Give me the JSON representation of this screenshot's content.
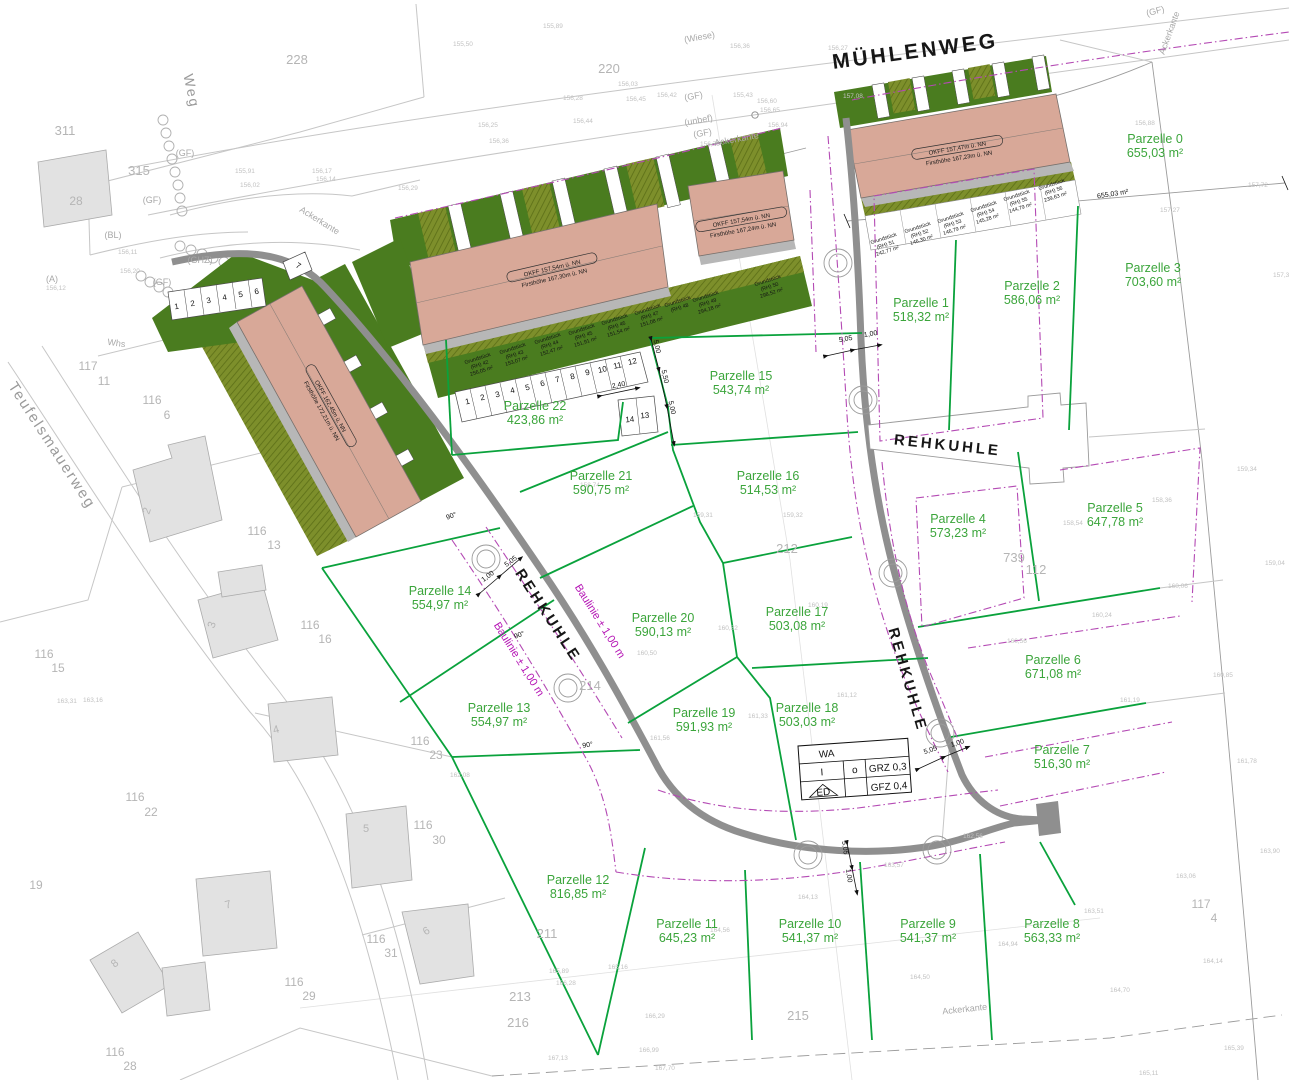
{
  "colors": {
    "parcel_green": "#3ba53b",
    "line_green": "#0aa23c",
    "building_fill": "#d8a898",
    "dark_green": "#4a7c1f",
    "olive": "#7d8f2b",
    "magenta": "#b44ab4",
    "road_gray": "#8f8f8f"
  },
  "legend": {
    "wa": "WA",
    "i": "I",
    "o": "o",
    "grz": "GRZ 0,3",
    "ed": "ED",
    "gfz": "GFZ 0,4"
  },
  "streets": [
    {
      "t": "MÜHLENWEG",
      "x": 916,
      "y": 58,
      "r": -7.5,
      "s": 21
    },
    {
      "t": "REHKUHLE",
      "x": 947,
      "y": 450,
      "r": 6,
      "s": 15
    },
    {
      "t": "REHKUHLE",
      "x": 544,
      "y": 618,
      "r": 57,
      "s": 15
    },
    {
      "t": "REHKUHLE",
      "x": 903,
      "y": 681,
      "r": 74,
      "s": 15
    }
  ],
  "gray_streets": [
    {
      "t": "Teufelsmauerweg",
      "x": 48,
      "y": 448,
      "r": 57,
      "s": 15
    },
    {
      "t": "Weg",
      "x": 187,
      "y": 92,
      "r": 78,
      "s": 14
    }
  ],
  "parcels": [
    {
      "label": "Parzelle 0",
      "area": "655,03 m²",
      "x": 1155,
      "y": 143
    },
    {
      "label": "Parzelle 1",
      "area": "518,32 m²",
      "x": 921,
      "y": 307
    },
    {
      "label": "Parzelle 2",
      "area": "586,06 m²",
      "x": 1032,
      "y": 290
    },
    {
      "label": "Parzelle 3",
      "area": "703,60 m²",
      "x": 1153,
      "y": 272
    },
    {
      "label": "Parzelle 4",
      "area": "573,23 m²",
      "x": 958,
      "y": 523
    },
    {
      "label": "Parzelle 5",
      "area": "647,78 m²",
      "x": 1115,
      "y": 512
    },
    {
      "label": "Parzelle 6",
      "area": "671,08 m²",
      "x": 1053,
      "y": 664
    },
    {
      "label": "Parzelle 7",
      "area": "516,30 m²",
      "x": 1062,
      "y": 754
    },
    {
      "label": "Parzelle 8",
      "area": "563,33 m²",
      "x": 1052,
      "y": 928
    },
    {
      "label": "Parzelle 9",
      "area": "541,37 m²",
      "x": 928,
      "y": 928
    },
    {
      "label": "Parzelle 10",
      "area": "541,37 m²",
      "x": 810,
      "y": 928
    },
    {
      "label": "Parzelle 11",
      "area": "645,23 m²",
      "x": 687,
      "y": 928
    },
    {
      "label": "Parzelle 12",
      "area": "816,85 m²",
      "x": 578,
      "y": 884
    },
    {
      "label": "Parzelle 13",
      "area": "554,97 m²",
      "x": 499,
      "y": 712
    },
    {
      "label": "Parzelle 14",
      "area": "554,97 m²",
      "x": 440,
      "y": 595
    },
    {
      "label": "Parzelle 15",
      "area": "543,74 m²",
      "x": 741,
      "y": 380
    },
    {
      "label": "Parzelle 16",
      "area": "514,53 m²",
      "x": 768,
      "y": 480
    },
    {
      "label": "Parzelle 17",
      "area": "503,08 m²",
      "x": 797,
      "y": 616
    },
    {
      "label": "Parzelle 18",
      "area": "503,03 m²",
      "x": 807,
      "y": 712
    },
    {
      "label": "Parzelle 19",
      "area": "591,93 m²",
      "x": 704,
      "y": 717
    },
    {
      "label": "Parzelle 20",
      "area": "590,13 m²",
      "x": 663,
      "y": 622
    },
    {
      "label": "Parzelle 21",
      "area": "590,75 m²",
      "x": 601,
      "y": 480
    },
    {
      "label": "Parzelle 22",
      "area": "423,86 m²",
      "x": 535,
      "y": 410
    }
  ],
  "buildings": [
    {
      "l1": "OKFF 157,47m ü. NN",
      "l2": "Firsthöhe 167,23m ü. NN",
      "x": 958,
      "y": 152,
      "r": -9.5
    },
    {
      "l1": "OKFF 157,54m ü. NN",
      "l2": "Firsthöhe 167,30m ü. NN",
      "x": 553,
      "y": 272,
      "r": -13
    },
    {
      "l1": "OKFF 157,54m ü. NN",
      "l2": "Firsthöhe 167,24m ü. NN",
      "x": 742,
      "y": 224,
      "r": -10
    },
    {
      "l1": "OKFF 162,45m ü. NN",
      "l2": "Firsthöhe 172,21m ü. NN",
      "x": 327,
      "y": 408,
      "r": 61
    }
  ],
  "grundstuecke": [
    {
      "a": "Grundstück",
      "b": "(RH) 51",
      "c": "242,77 m²",
      "x": 884,
      "y": 240,
      "r": -18
    },
    {
      "a": "Grundstück",
      "b": "(RH) 52",
      "c": "146,30 m²",
      "x": 918,
      "y": 229,
      "r": -18
    },
    {
      "a": "Grundstück",
      "b": "(RH) 53",
      "c": "146,79 m²",
      "x": 951,
      "y": 219,
      "r": -18
    },
    {
      "a": "Grundstück",
      "b": "(RH) 54",
      "c": "145,28 m²",
      "x": 984,
      "y": 208,
      "r": -18
    },
    {
      "a": "Grundstück",
      "b": "(RH) 55",
      "c": "144,79 m²",
      "x": 1017,
      "y": 197,
      "r": -18
    },
    {
      "a": "Grundstück",
      "b": "(RH) 56",
      "c": "239,63 m²",
      "x": 1052,
      "y": 186,
      "r": -18
    },
    {
      "a": "Grundstück",
      "b": "(RH) 42",
      "c": "256,05 m²",
      "x": 478,
      "y": 360,
      "r": -18
    },
    {
      "a": "Grundstück",
      "b": "(RH) 43",
      "c": "153,07 m²",
      "x": 513,
      "y": 350,
      "r": -18
    },
    {
      "a": "Grundstück",
      "b": "(RH) 44",
      "c": "152,47 m²",
      "x": 548,
      "y": 340,
      "r": -18
    },
    {
      "a": "Grundstück",
      "b": "(RH) 45",
      "c": "151,91 m²",
      "x": 582,
      "y": 331,
      "r": -18
    },
    {
      "a": "Grundstück",
      "b": "(RH) 46",
      "c": "151,54 m²",
      "x": 615,
      "y": 321,
      "r": -18
    },
    {
      "a": "Grundstück",
      "b": "(RH) 47",
      "c": "151,08 m²",
      "x": 648,
      "y": 311,
      "r": -18
    },
    {
      "a": "Grundstück",
      "b": "(RH) 48",
      "c": "",
      "x": 678,
      "y": 303,
      "r": -18
    },
    {
      "a": "Grundstück",
      "b": "(RH) 49",
      "c": "294,18 m²",
      "x": 706,
      "y": 298,
      "r": -18
    },
    {
      "a": "Grundstück",
      "b": "(RH) 50",
      "c": "298,52 m²",
      "x": 768,
      "y": 282,
      "r": -18
    }
  ],
  "baulinie": [
    {
      "t": "Baulinie ± 1,00 m",
      "x": 597,
      "y": 623,
      "r": 58
    },
    {
      "t": "Baulinie ± 1,00 m",
      "x": 516,
      "y": 661,
      "r": 58
    }
  ],
  "dims": [
    {
      "t": "5,05",
      "x": 846,
      "y": 341,
      "r": -10
    },
    {
      "t": "1,00",
      "x": 871,
      "y": 336,
      "r": -10
    },
    {
      "t": "5,05",
      "x": 931,
      "y": 752,
      "r": -18
    },
    {
      "t": "1,00",
      "x": 958,
      "y": 745,
      "r": -18
    },
    {
      "t": "5,05",
      "x": 843,
      "y": 848,
      "r": 82
    },
    {
      "t": "1,00",
      "x": 847,
      "y": 876,
      "r": 82
    },
    {
      "t": "5,05",
      "x": 512,
      "y": 563,
      "r": -37
    },
    {
      "t": "1,00",
      "x": 489,
      "y": 578,
      "r": -37
    },
    {
      "t": "5,00",
      "x": 655,
      "y": 347,
      "r": 77
    },
    {
      "t": "5,50",
      "x": 663,
      "y": 377,
      "r": 77
    },
    {
      "t": "5,00",
      "x": 670,
      "y": 408,
      "r": 77
    },
    {
      "t": "2,40",
      "x": 619,
      "y": 387,
      "r": -12
    },
    {
      "t": "655,03 m²",
      "x": 1113,
      "y": 196,
      "r": -9,
      "s": 8
    }
  ],
  "angles": [
    {
      "t": "90°",
      "x": 520,
      "y": 637,
      "r": -20
    },
    {
      "t": "90°",
      "x": 588,
      "y": 747,
      "r": -10
    },
    {
      "t": "90°",
      "x": 452,
      "y": 518,
      "r": -20
    }
  ],
  "gray_numbers": [
    {
      "t": "228",
      "x": 297,
      "y": 64
    },
    {
      "t": "220",
      "x": 609,
      "y": 73
    },
    {
      "t": "311",
      "x": 65,
      "y": 135
    },
    {
      "t": "315",
      "x": 139,
      "y": 175
    },
    {
      "t": "28",
      "x": 76,
      "y": 205,
      "s": 12
    },
    {
      "t": "212",
      "x": 787,
      "y": 553
    },
    {
      "t": "214",
      "x": 590,
      "y": 690
    },
    {
      "t": "739",
      "x": 1014,
      "y": 562
    },
    {
      "t": "112",
      "x": 1036,
      "y": 574
    },
    {
      "t": "215",
      "x": 798,
      "y": 1020
    },
    {
      "t": "211",
      "x": 547,
      "y": 938
    },
    {
      "t": "213",
      "x": 520,
      "y": 1001
    },
    {
      "t": "216",
      "x": 518,
      "y": 1027
    },
    {
      "t": "19",
      "x": 36,
      "y": 889,
      "s": 12
    },
    {
      "t": "117",
      "x": 88,
      "y": 370,
      "s": 12
    },
    {
      "t": "11",
      "x": 104,
      "y": 385,
      "s": 12
    },
    {
      "t": "116",
      "x": 152,
      "y": 404,
      "s": 12
    },
    {
      "t": "6",
      "x": 167,
      "y": 419,
      "s": 12
    },
    {
      "t": "116",
      "x": 257,
      "y": 535,
      "s": 12
    },
    {
      "t": "13",
      "x": 274,
      "y": 549,
      "s": 12
    },
    {
      "t": "116",
      "x": 310,
      "y": 629,
      "s": 12
    },
    {
      "t": "16",
      "x": 325,
      "y": 643,
      "s": 12
    },
    {
      "t": "116",
      "x": 44,
      "y": 658,
      "s": 12
    },
    {
      "t": "15",
      "x": 58,
      "y": 672,
      "s": 12
    },
    {
      "t": "116",
      "x": 420,
      "y": 745,
      "s": 12
    },
    {
      "t": "23",
      "x": 436,
      "y": 759,
      "s": 12
    },
    {
      "t": "116",
      "x": 135,
      "y": 801,
      "s": 12
    },
    {
      "t": "22",
      "x": 151,
      "y": 816,
      "s": 12
    },
    {
      "t": "116",
      "x": 423,
      "y": 829,
      "s": 12
    },
    {
      "t": "30",
      "x": 439,
      "y": 844,
      "s": 12
    },
    {
      "t": "116",
      "x": 376,
      "y": 943,
      "s": 12
    },
    {
      "t": "31",
      "x": 391,
      "y": 957,
      "s": 12
    },
    {
      "t": "116",
      "x": 294,
      "y": 986,
      "s": 12
    },
    {
      "t": "29",
      "x": 309,
      "y": 1000,
      "s": 12
    },
    {
      "t": "116",
      "x": 115,
      "y": 1056,
      "s": 12
    },
    {
      "t": "28",
      "x": 130,
      "y": 1070,
      "s": 12
    },
    {
      "t": "117",
      "x": 1201,
      "y": 908,
      "s": 12
    },
    {
      "t": "4",
      "x": 1214,
      "y": 922,
      "s": 12
    },
    {
      "t": "2",
      "x": 150,
      "y": 512,
      "s": 11,
      "r": -70
    },
    {
      "t": "3",
      "x": 215,
      "y": 626,
      "s": 11,
      "r": -70
    },
    {
      "t": "4",
      "x": 277,
      "y": 733,
      "s": 11,
      "r": -15
    },
    {
      "t": "5",
      "x": 366,
      "y": 832,
      "s": 11
    },
    {
      "t": "6",
      "x": 428,
      "y": 934,
      "s": 11,
      "r": -30
    },
    {
      "t": "7",
      "x": 229,
      "y": 908,
      "s": 11,
      "r": -15
    },
    {
      "t": "8",
      "x": 117,
      "y": 966,
      "s": 11,
      "r": -40
    }
  ],
  "misc": [
    {
      "t": "(Wiese)",
      "x": 700,
      "y": 40,
      "r": -10
    },
    {
      "t": "(GF)",
      "x": 694,
      "y": 99,
      "r": -10
    },
    {
      "t": "(unbef)",
      "x": 699,
      "y": 123,
      "r": -10
    },
    {
      "t": "(GF)",
      "x": 703,
      "y": 136,
      "r": -10
    },
    {
      "t": "(GF)",
      "x": 185,
      "y": 156,
      "r": 0
    },
    {
      "t": "(GF)",
      "x": 152,
      "y": 203,
      "r": 0
    },
    {
      "t": "(GHZ)",
      "x": 200,
      "y": 263,
      "r": 0
    },
    {
      "t": "(BL)",
      "x": 113,
      "y": 238,
      "r": 0
    },
    {
      "t": "(A)",
      "x": 52,
      "y": 282,
      "r": 0
    },
    {
      "t": "(GF)",
      "x": 162,
      "y": 285,
      "r": 0
    },
    {
      "t": "Whs",
      "x": 116,
      "y": 346,
      "r": 8
    },
    {
      "t": "Ackerkante",
      "x": 318,
      "y": 223,
      "r": 32
    },
    {
      "t": "Ackerkante",
      "x": 737,
      "y": 142,
      "r": -10
    },
    {
      "t": "Ackerkante",
      "x": 965,
      "y": 1012,
      "r": -6
    },
    {
      "t": "Ackerkante",
      "x": 1172,
      "y": 34,
      "r": -70
    },
    {
      "t": "(GF)",
      "x": 1156,
      "y": 14,
      "r": -15
    }
  ],
  "parking": [
    {
      "t": "1",
      "x": 468,
      "y": 404,
      "r": -13
    },
    {
      "t": "2",
      "x": 483,
      "y": 400,
      "r": -13
    },
    {
      "t": "3",
      "x": 498,
      "y": 397,
      "r": -13
    },
    {
      "t": "4",
      "x": 513,
      "y": 393,
      "r": -13
    },
    {
      "t": "5",
      "x": 528,
      "y": 390,
      "r": -13
    },
    {
      "t": "6",
      "x": 543,
      "y": 386,
      "r": -13
    },
    {
      "t": "7",
      "x": 558,
      "y": 382,
      "r": -13
    },
    {
      "t": "8",
      "x": 573,
      "y": 379,
      "r": -13
    },
    {
      "t": "9",
      "x": 588,
      "y": 375,
      "r": -13
    },
    {
      "t": "10",
      "x": 603,
      "y": 372,
      "r": -13
    },
    {
      "t": "11",
      "x": 618,
      "y": 368,
      "r": -13
    },
    {
      "t": "12",
      "x": 633,
      "y": 364,
      "r": -13
    },
    {
      "t": "14",
      "x": 630,
      "y": 422,
      "r": -5
    },
    {
      "t": "13",
      "x": 645,
      "y": 418,
      "r": -5
    },
    {
      "t": "1",
      "x": 177,
      "y": 309,
      "r": -10
    },
    {
      "t": "2",
      "x": 193,
      "y": 306,
      "r": -10
    },
    {
      "t": "3",
      "x": 209,
      "y": 303,
      "r": -10
    },
    {
      "t": "4",
      "x": 225,
      "y": 300,
      "r": -10
    },
    {
      "t": "5",
      "x": 241,
      "y": 297,
      "r": -10
    },
    {
      "t": "6",
      "x": 257,
      "y": 294,
      "r": -10
    },
    {
      "t": "7",
      "x": 297,
      "y": 268,
      "r": 30
    }
  ],
  "elevations": [
    {
      "t": "155,89",
      "x": 543,
      "y": 28
    },
    {
      "t": "155,50",
      "x": 453,
      "y": 46
    },
    {
      "t": "156,03",
      "x": 618,
      "y": 86
    },
    {
      "t": "155,43",
      "x": 733,
      "y": 97
    },
    {
      "t": "156,45",
      "x": 626,
      "y": 101
    },
    {
      "t": "156,36",
      "x": 730,
      "y": 48
    },
    {
      "t": "156,27",
      "x": 828,
      "y": 50
    },
    {
      "t": "157,08",
      "x": 843,
      "y": 98
    },
    {
      "t": "156,79",
      "x": 700,
      "y": 146
    },
    {
      "t": "156,94",
      "x": 768,
      "y": 127
    },
    {
      "t": "156,60",
      "x": 757,
      "y": 103
    },
    {
      "t": "156,65",
      "x": 760,
      "y": 112
    },
    {
      "t": "156,42",
      "x": 657,
      "y": 97
    },
    {
      "t": "156,28",
      "x": 563,
      "y": 100
    },
    {
      "t": "156,25",
      "x": 478,
      "y": 127
    },
    {
      "t": "156,44",
      "x": 573,
      "y": 123
    },
    {
      "t": "156,36",
      "x": 489,
      "y": 143
    },
    {
      "t": "156,29",
      "x": 398,
      "y": 190
    },
    {
      "t": "156,17",
      "x": 312,
      "y": 173
    },
    {
      "t": "156,14",
      "x": 316,
      "y": 181
    },
    {
      "t": "155,91",
      "x": 235,
      "y": 173
    },
    {
      "t": "156,02",
      "x": 240,
      "y": 187
    },
    {
      "t": "156,11",
      "x": 118,
      "y": 254
    },
    {
      "t": "156,20",
      "x": 120,
      "y": 273
    },
    {
      "t": "156,12",
      "x": 46,
      "y": 290
    },
    {
      "t": "156,88",
      "x": 1135,
      "y": 125
    },
    {
      "t": "157,27",
      "x": 1160,
      "y": 212
    },
    {
      "t": "157,72",
      "x": 1248,
      "y": 187
    },
    {
      "t": "157,38",
      "x": 1273,
      "y": 277
    },
    {
      "t": "158,36",
      "x": 1152,
      "y": 502
    },
    {
      "t": "158,54",
      "x": 1063,
      "y": 525
    },
    {
      "t": "159,34",
      "x": 1237,
      "y": 471
    },
    {
      "t": "159,04",
      "x": 1265,
      "y": 565
    },
    {
      "t": "160,24",
      "x": 1092,
      "y": 617
    },
    {
      "t": "160,56",
      "x": 1007,
      "y": 643
    },
    {
      "t": "160,06",
      "x": 1168,
      "y": 588
    },
    {
      "t": "161,19",
      "x": 1120,
      "y": 702
    },
    {
      "t": "160,85",
      "x": 1213,
      "y": 677
    },
    {
      "t": "161,78",
      "x": 1237,
      "y": 763
    },
    {
      "t": "162,56",
      "x": 963,
      "y": 838
    },
    {
      "t": "163,31",
      "x": 57,
      "y": 703
    },
    {
      "t": "163,16",
      "x": 83,
      "y": 702
    },
    {
      "t": "162,08",
      "x": 450,
      "y": 777
    },
    {
      "t": "163,90",
      "x": 1260,
      "y": 853
    },
    {
      "t": "163,06",
      "x": 1176,
      "y": 878
    },
    {
      "t": "164,14",
      "x": 1203,
      "y": 963
    },
    {
      "t": "164,70",
      "x": 1110,
      "y": 992
    },
    {
      "t": "165,39",
      "x": 1224,
      "y": 1050
    },
    {
      "t": "165,11",
      "x": 1139,
      "y": 1075
    },
    {
      "t": "164,13",
      "x": 798,
      "y": 899
    },
    {
      "t": "164,56",
      "x": 710,
      "y": 932
    },
    {
      "t": "164,50",
      "x": 910,
      "y": 979
    },
    {
      "t": "164,94",
      "x": 998,
      "y": 946
    },
    {
      "t": "163,57",
      "x": 884,
      "y": 867
    },
    {
      "t": "163,51",
      "x": 1084,
      "y": 913
    },
    {
      "t": "165,16",
      "x": 608,
      "y": 969
    },
    {
      "t": "165,89",
      "x": 549,
      "y": 973
    },
    {
      "t": "166,28",
      "x": 556,
      "y": 985
    },
    {
      "t": "166,29",
      "x": 645,
      "y": 1018
    },
    {
      "t": "166,99",
      "x": 639,
      "y": 1052
    },
    {
      "t": "167,70",
      "x": 655,
      "y": 1070
    },
    {
      "t": "167,13",
      "x": 548,
      "y": 1060
    },
    {
      "t": "159,32",
      "x": 783,
      "y": 517
    },
    {
      "t": "160,19",
      "x": 808,
      "y": 607
    },
    {
      "t": "160,32",
      "x": 718,
      "y": 630
    },
    {
      "t": "160,50",
      "x": 637,
      "y": 655
    },
    {
      "t": "161,33",
      "x": 748,
      "y": 718
    },
    {
      "t": "161,12",
      "x": 837,
      "y": 697
    },
    {
      "t": "161,56",
      "x": 650,
      "y": 740
    },
    {
      "t": "158,74",
      "x": 580,
      "y": 487
    },
    {
      "t": "159,31",
      "x": 693,
      "y": 517
    }
  ]
}
